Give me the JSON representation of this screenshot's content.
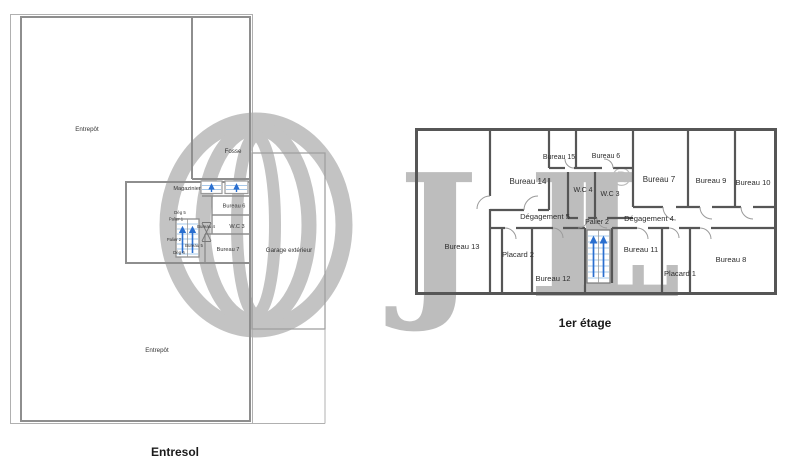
{
  "document": {
    "type": "floor-plan-drawing",
    "background": "#ffffff"
  },
  "watermark": {
    "icon": "jll-globe-logo",
    "letter_j": "J",
    "letter_l1": "L",
    "letter_l2": "L",
    "registered": "®",
    "color": "#b9b9b9"
  },
  "colors": {
    "wall_entresol": "#8e8e8e",
    "wall_etage": "#565656",
    "outline": "#b0b0b0",
    "label": "#333333",
    "title": "#1b1b1b",
    "stair_step": "#a6c8ea",
    "stair_arrow": "#2a6fd0"
  },
  "plans": {
    "entresol": {
      "title": "Entresol",
      "rooms": {
        "entrepot_haut": "Entrepôt",
        "fosse": "Fosse",
        "magazinier": "Magazinier",
        "bureau_6": "Bureau 6",
        "wc_3": "W.C 3",
        "bureau_7": "Bureau 7",
        "deg_5": "Dég 5",
        "palier_1": "Palier 1",
        "bureau_4": "Bureau 4",
        "palier_2": "Palier 2",
        "bureau_5": "Bureau 5",
        "deg_6": "Dég 6",
        "garage": "Garage extérieur",
        "entrepot_bas": "Entrepôt"
      }
    },
    "premier_etage": {
      "title": "1er étage",
      "rooms": {
        "bureau_13": "Bureau 13",
        "bureau_14": "Bureau 14",
        "bureau_15": "Bureau 15",
        "bureau_6": "Bureau 6",
        "wc_4": "W.C 4",
        "wc_3": "W.C 3",
        "bureau_7": "Bureau 7",
        "bureau_9": "Bureau 9",
        "bureau_10": "Bureau 10",
        "degagement_5": "Dégagement 5",
        "degagement_4": "Dégagement 4",
        "palier_2": "Palier 2",
        "placard_2": "Placard 2",
        "bureau_12": "Bureau 12",
        "bureau_11": "Bureau 11",
        "placard_1": "Placard 1",
        "bureau_8": "Bureau 8"
      }
    }
  }
}
